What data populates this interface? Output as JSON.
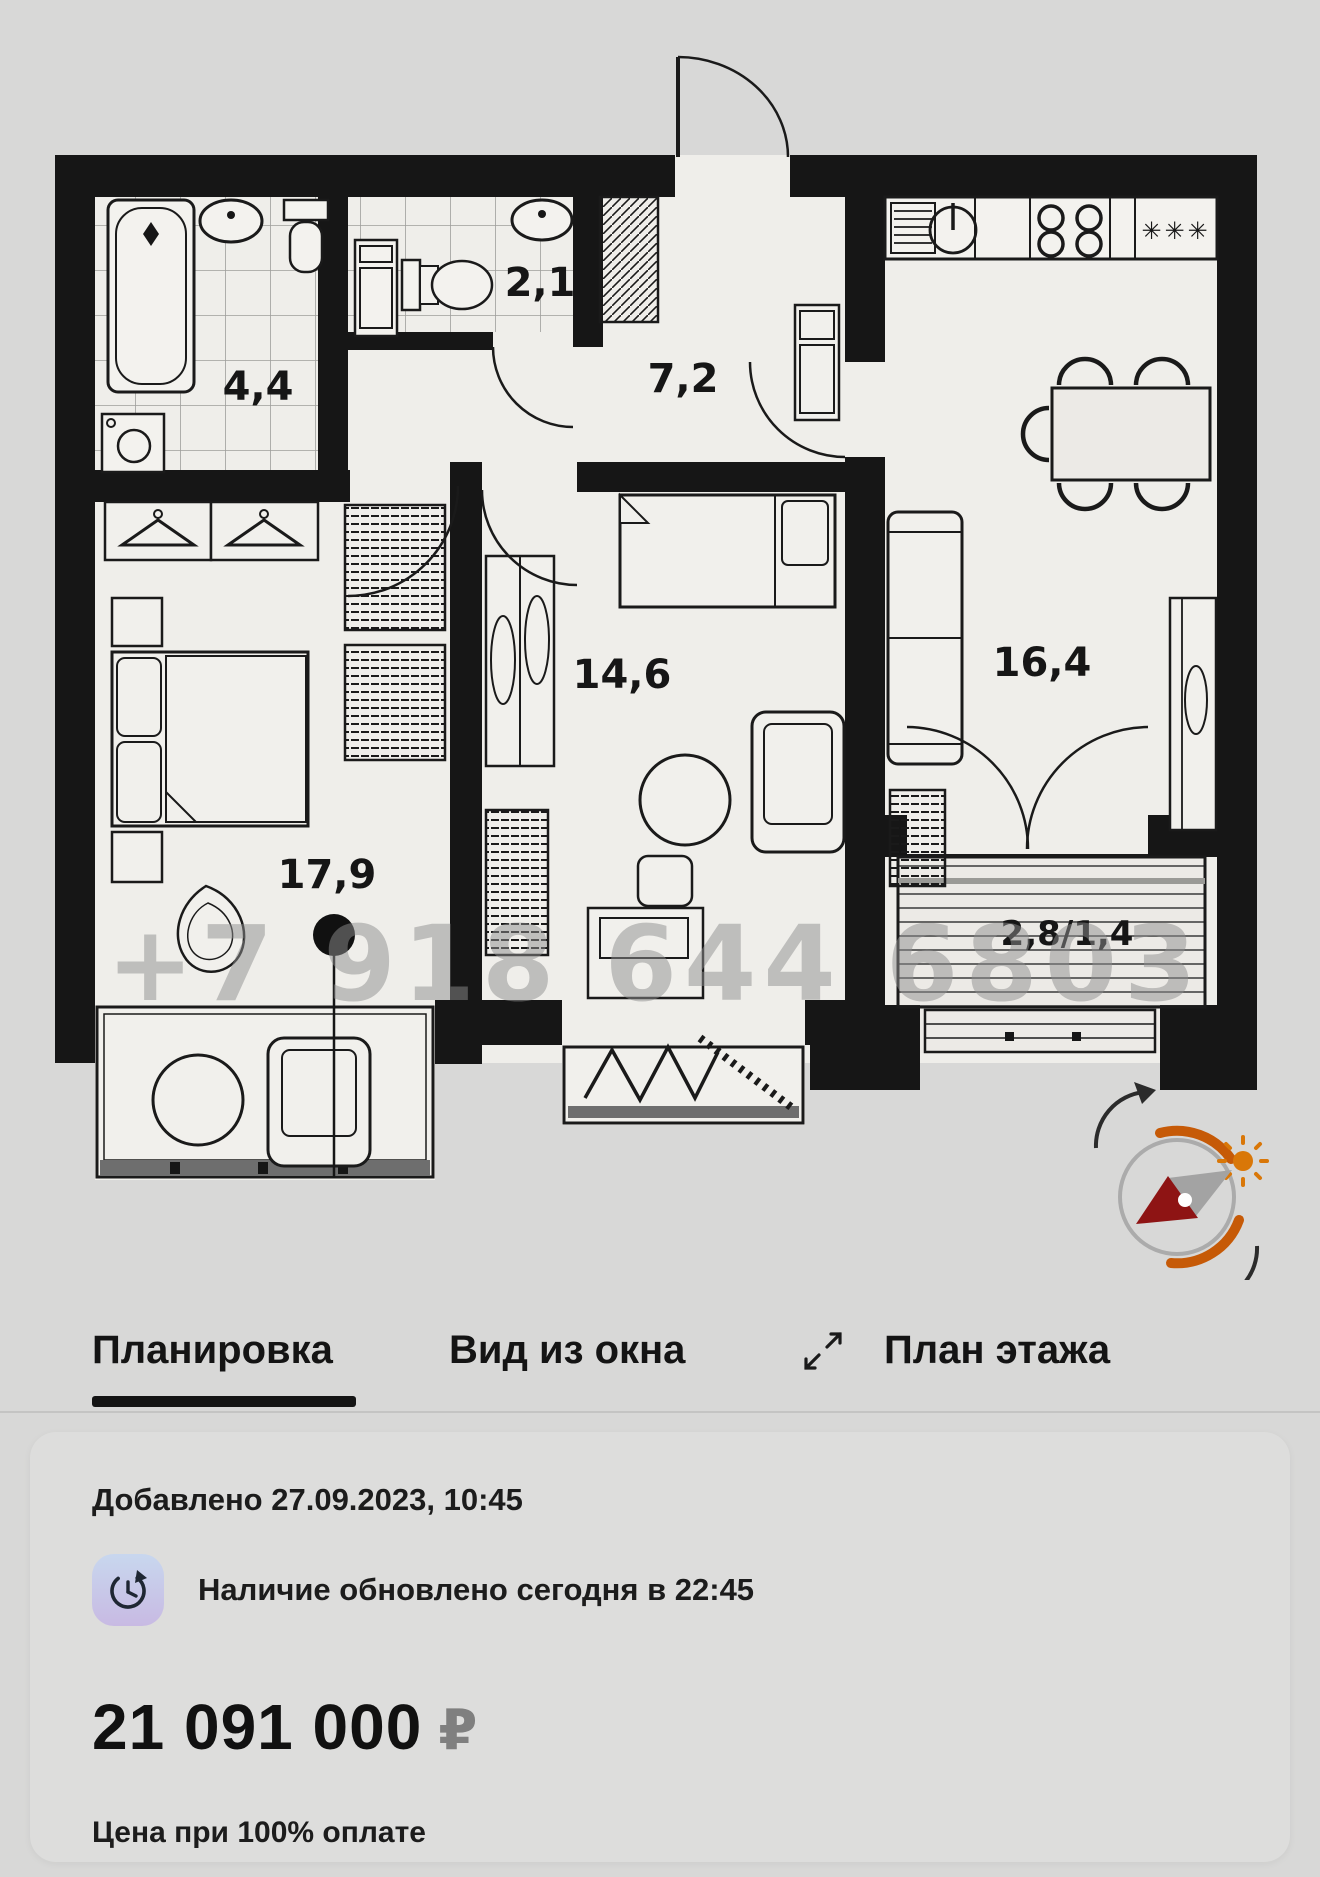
{
  "plan": {
    "watermark": "+7 918 644 6803",
    "rooms": [
      {
        "id": "bathroom",
        "label": "4,4"
      },
      {
        "id": "wc",
        "label": "2,1"
      },
      {
        "id": "hallway",
        "label": "7,2"
      },
      {
        "id": "bedroom",
        "label": "14,6"
      },
      {
        "id": "living-kitchen",
        "label": "16,4"
      },
      {
        "id": "master-bedroom",
        "label": "17,9"
      },
      {
        "id": "balcony",
        "label": "2,8/1,4"
      }
    ],
    "fridge_stars": "✳✳✳"
  },
  "tabs": {
    "items": [
      {
        "label": "Планировка",
        "active": true
      },
      {
        "label": "Вид из окна",
        "active": false
      },
      {
        "label": "План этажа",
        "active": false
      }
    ]
  },
  "card": {
    "added": "Добавлено 27.09.2023, 10:45",
    "availability": "Наличие обновлено сегодня в 22:45",
    "price": "21 091 000",
    "currency": "₽",
    "price_note": "Цена при 100% оплате"
  },
  "icons": {
    "compass": "sun-orientation-compass",
    "expand": "expand-arrows",
    "clock": "availability-refresh-clock"
  },
  "colors": {
    "page_bg": "#d8d8d7",
    "card_bg": "#dddddc",
    "floor": "#efeeea",
    "wall": "#161616",
    "accent_orange": "#c65a07",
    "needle_red": "#8e1414",
    "watermark_gray": "#8f8f8f",
    "badge_top": "#c8d7ee",
    "badge_bottom": "#c8bae3"
  }
}
